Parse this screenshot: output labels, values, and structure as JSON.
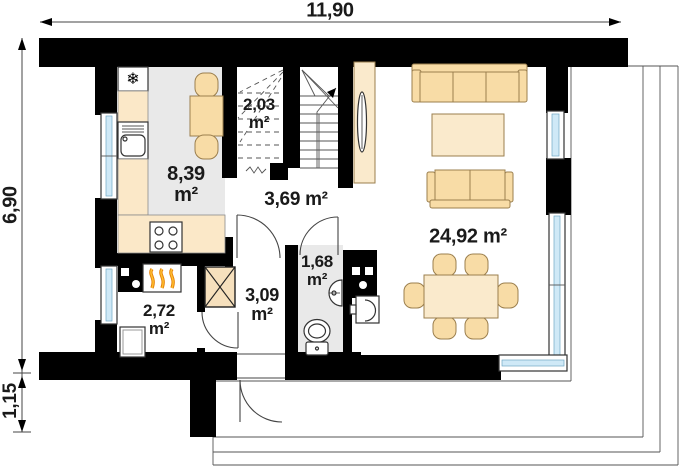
{
  "dimensions": {
    "width": "11,90",
    "height": "6,90",
    "porch_depth": "1,15"
  },
  "rooms": [
    {
      "name": "kitchen",
      "area": "8,39\nm²"
    },
    {
      "name": "staircase",
      "area": "2,03\nm²"
    },
    {
      "name": "hall",
      "area": "3,69 m²"
    },
    {
      "name": "living-room",
      "area": "24,92 m²"
    },
    {
      "name": "utility-room",
      "area": "2,72\nm²"
    },
    {
      "name": "vestibule",
      "area": "3,09\nm²"
    },
    {
      "name": "bathroom",
      "area": "1,68\nm²"
    }
  ],
  "icons": {
    "fridge_snowflake": "❄"
  },
  "colors": {
    "wall": "#000000",
    "room_floor": "#e9e9e9",
    "furniture": "#f8dca6",
    "furniture_light": "#faeacc",
    "counter": "#fbe8c8",
    "glass": "#cfe9f7",
    "flame_outer": "#e8830a",
    "flame_inner": "#ffc233",
    "line": "#555555",
    "label": "#1a1a1a"
  }
}
